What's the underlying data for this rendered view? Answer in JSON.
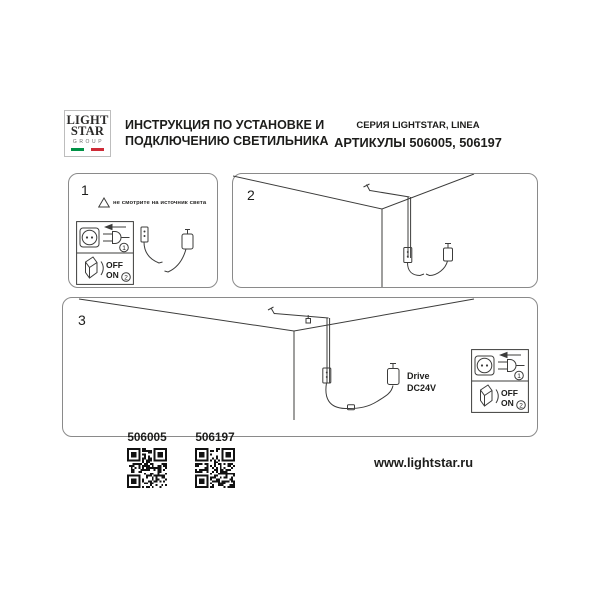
{
  "header": {
    "logo": {
      "line1": "LIGHT",
      "line2": "STAR",
      "line3": "GROUP"
    },
    "title_line1": "ИНСТРУКЦИЯ ПО УСТАНОВКЕ И",
    "title_line2": "ПОДКЛЮЧЕНИЮ СВЕТИЛЬНИКА",
    "series": "СЕРИЯ LIGHTSTAR, LINEA",
    "articles": "АРТИКУЛЫ 506005, 506197"
  },
  "icon_box": {
    "plug_step": "1",
    "switch_step": "2",
    "off_label": "OFF",
    "on_label": "ON"
  },
  "steps": {
    "step1": {
      "number": "1",
      "warning": "не смотрите на источник света"
    },
    "step2": {
      "number": "2"
    },
    "step3": {
      "number": "3",
      "driver_line1": "Drive",
      "driver_line2": "DC24V"
    }
  },
  "footer": {
    "qr_codes": [
      {
        "label": "506005"
      },
      {
        "label": "506197"
      }
    ],
    "website": "www.lightstar.ru"
  },
  "colors": {
    "flag_green": "#009246",
    "flag_red": "#ce2b37",
    "line_art": "#3c3c3b",
    "text": "#1d1d1b"
  }
}
